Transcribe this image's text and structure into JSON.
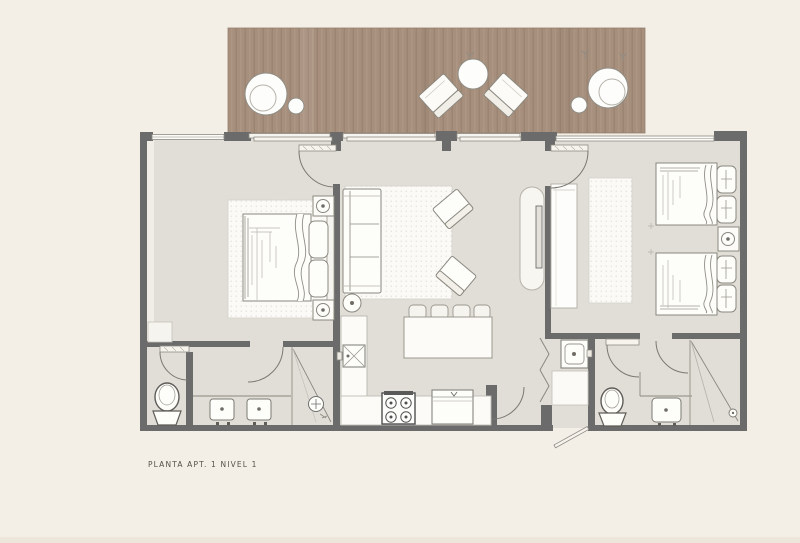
{
  "caption": "PLANTA APT. 1 NIVEL 1",
  "colors": {
    "background": "#f4efe6",
    "deck_wood": "#a78f7d",
    "deck_grain_dark": "#97806f",
    "deck_grain_light": "#b29b89",
    "floor": "#e1ded7",
    "wall": "#6b6b6b",
    "rug": "#fbfaf6",
    "furniture_fill": "#fdfdfa",
    "furniture_outline": "#8a887f",
    "appliance_outline": "#4f4f4f",
    "caption_text": "#53514b"
  },
  "plan": {
    "type": "architectural-floor-plan",
    "areas": [
      "deck-terrace",
      "bedroom-left",
      "living-room",
      "dining-area",
      "kitchen",
      "bathroom-left",
      "utility-closet",
      "bathroom-right",
      "bedroom-right",
      "entry"
    ],
    "furniture": [
      "deck-dining-table",
      "deck-stool",
      "lounge-chair",
      "lounge-chair",
      "deck-side-table",
      "deck-table",
      "deck-stool",
      "double-bed",
      "pillows",
      "nightstand",
      "nightstand",
      "bedroom-rug",
      "linen-closet",
      "sofa",
      "floor-lamp",
      "armchair",
      "armchair",
      "living-rug",
      "tv-console",
      "wall-tv",
      "dining-chairs",
      "dining-table",
      "kitchen-sink-counter",
      "stove",
      "kitchen-cabinet",
      "toilet",
      "double-sink-vanity",
      "shower",
      "bifold-closet-doors",
      "washing-machine",
      "utility-shelf",
      "toilet",
      "sink-vanity",
      "shower",
      "full-bed",
      "full-bed",
      "nightstand",
      "built-in-closet",
      "bedroom-rug",
      "entry-door"
    ]
  }
}
